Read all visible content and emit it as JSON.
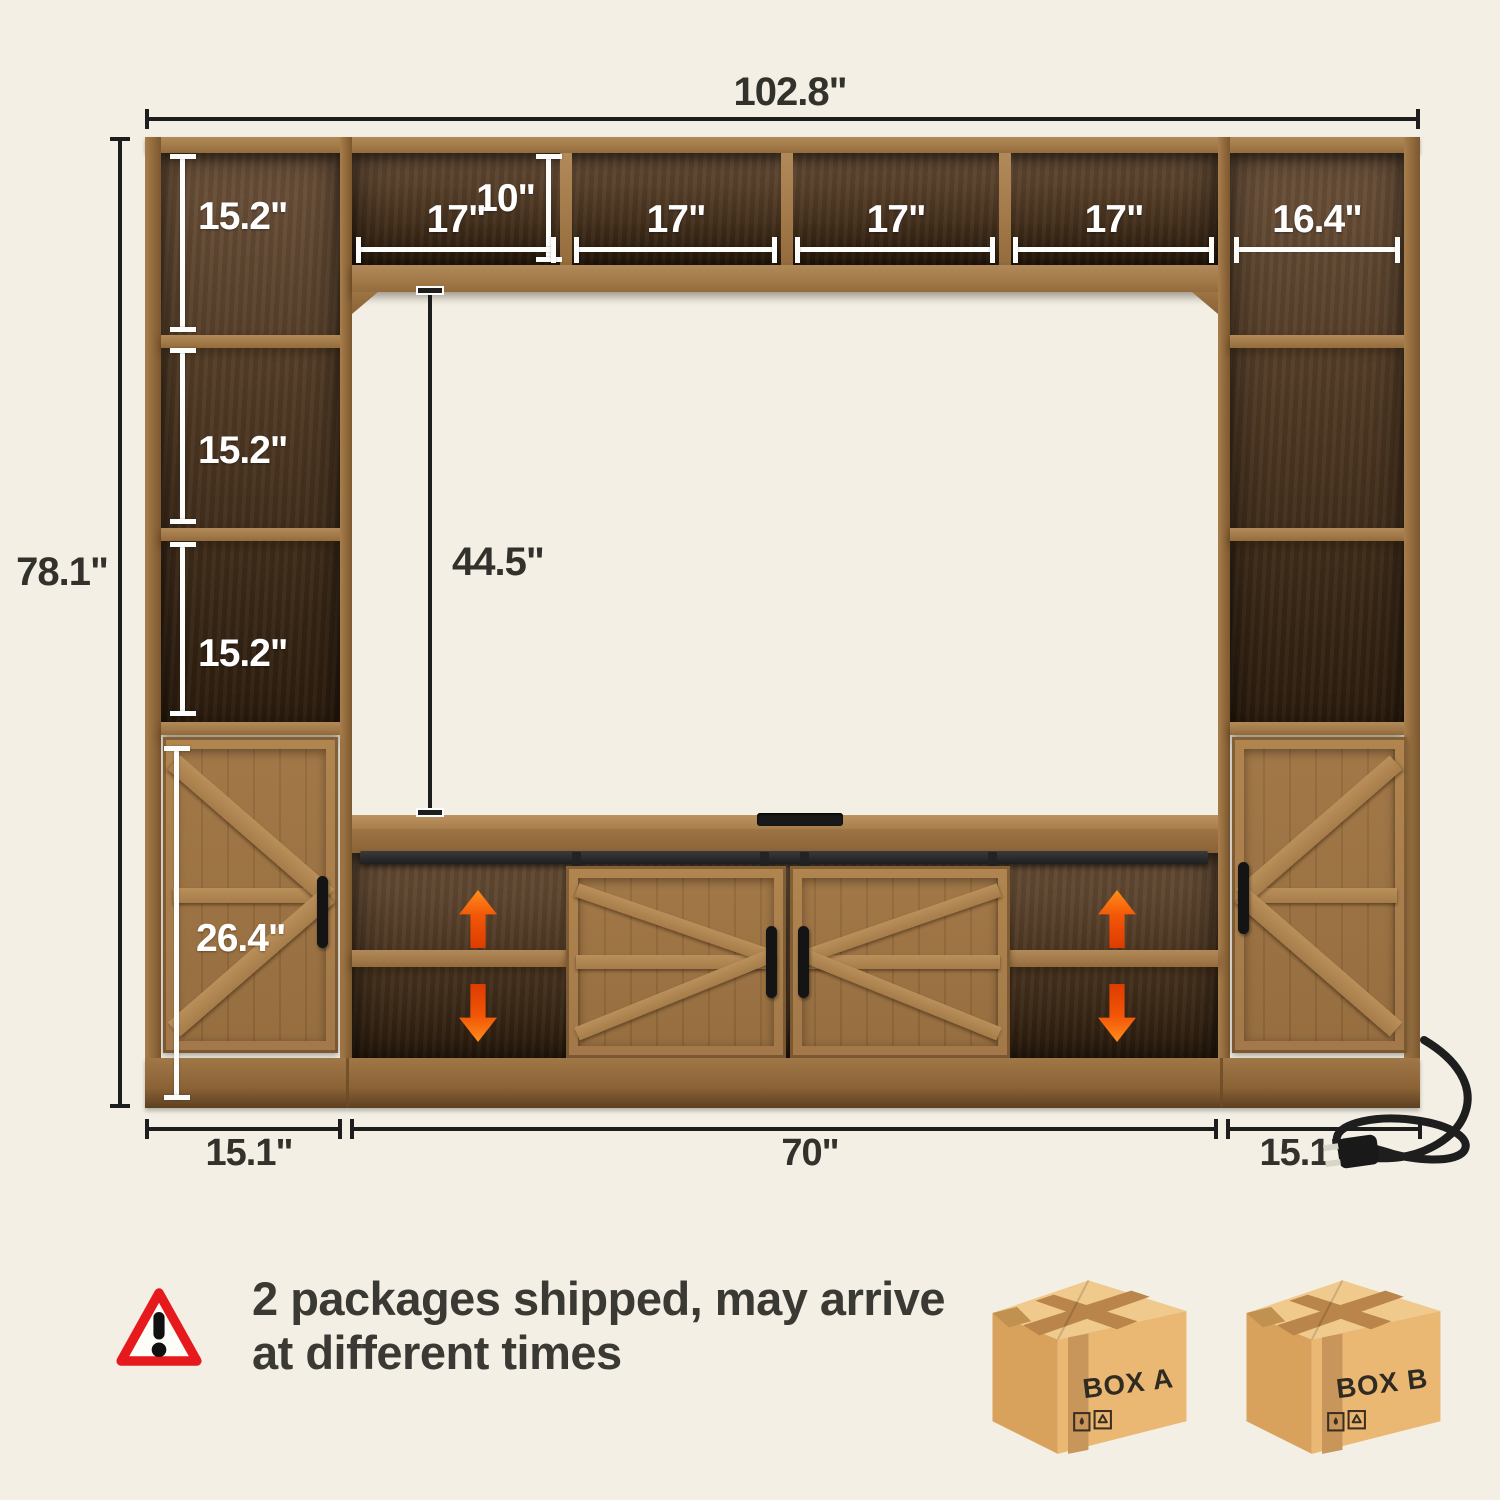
{
  "page": {
    "background": "#f3efe5"
  },
  "dims": {
    "total_width": "102.8\"",
    "total_height": "78.1\"",
    "hutch_height": "10\"",
    "hutch_cubbies": [
      "17\"",
      "17\"",
      "17\"",
      "17\""
    ],
    "left_cubbies": [
      "15.2\"",
      "15.2\"",
      "15.2\""
    ],
    "right_top_cubby": "16.4\"",
    "tv_opening_height": "44.5\"",
    "side_cabinet_height": "26.4\"",
    "bottom_left": "15.1\"",
    "bottom_center": "70\"",
    "bottom_right": "15.1\""
  },
  "notice": {
    "line1": "2 packages shipped, may arrive",
    "line2": "at different times"
  },
  "boxes": [
    {
      "label": "BOX A"
    },
    {
      "label": "BOX B"
    }
  ],
  "icons": {
    "warning": "warning-triangle-icon",
    "shelf_up": "arrow-up-icon",
    "shelf_down": "arrow-down-icon",
    "power": "power-plug-icon",
    "keep_dry": "keep-dry-icon",
    "recycle": "recycle-icon"
  },
  "colors": {
    "background": "#f3efe5",
    "wood": "#9c7343",
    "wood_interior_dark": "#3a2817",
    "dimension_dark": "#1d1d1d",
    "dimension_white": "#ffffff",
    "arrow_orange": "#f2570a",
    "warning_red": "#e6191c",
    "cardboard": "#eab873"
  }
}
